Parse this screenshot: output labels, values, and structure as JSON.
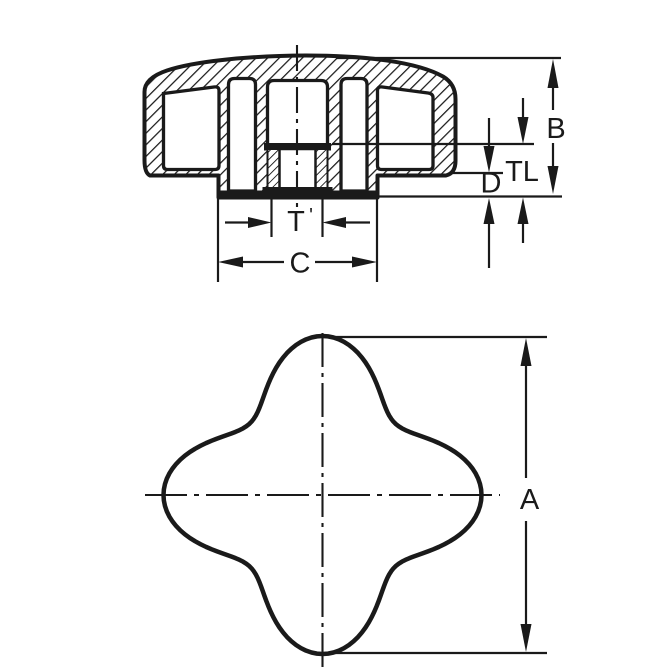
{
  "dims": {
    "a": "A",
    "b": "B",
    "tl": "TL",
    "d": "D",
    "t": "T",
    "t_mark": "'",
    "c": "C"
  },
  "colors": {
    "ink": "#1a1a1a",
    "paper": "#ffffff"
  }
}
